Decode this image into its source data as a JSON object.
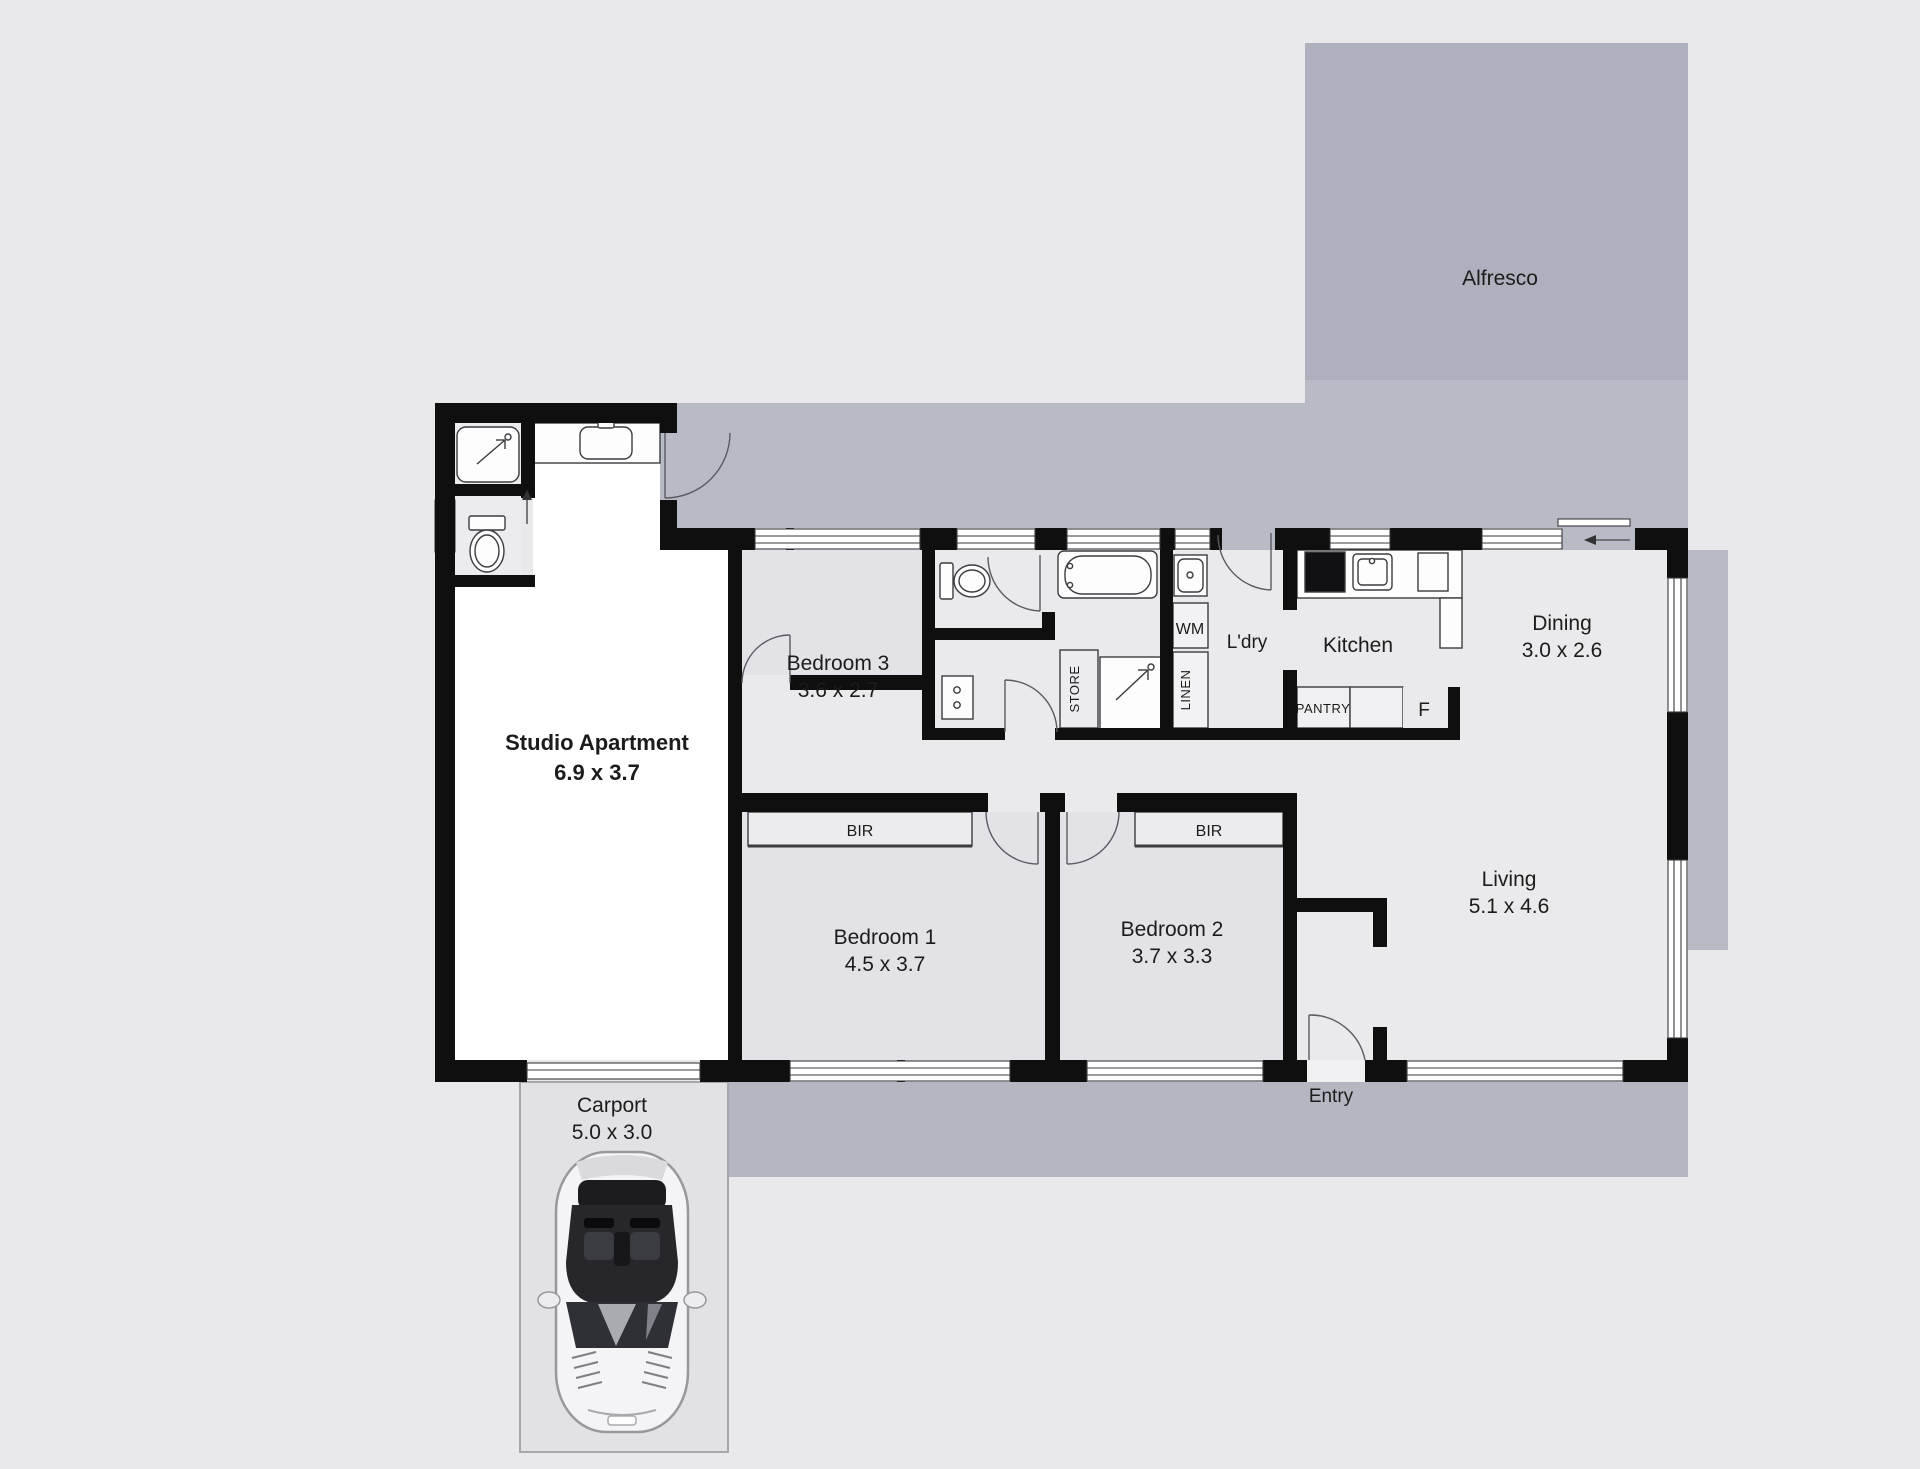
{
  "plan": {
    "alfresco": {
      "name": "Alfresco"
    },
    "studio": {
      "name": "Studio Apartment",
      "dims": "6.9 x 3.7"
    },
    "bedroom3": {
      "name": "Bedroom 3",
      "dims": "3.6 x 2.7"
    },
    "bedroom1": {
      "name": "Bedroom 1",
      "dims": "4.5 x 3.7"
    },
    "bedroom2": {
      "name": "Bedroom 2",
      "dims": "3.7 x 3.3"
    },
    "living": {
      "name": "Living",
      "dims": "5.1 x 4.6"
    },
    "dining": {
      "name": "Dining",
      "dims": "3.0 x 2.6"
    },
    "kitchen": {
      "name": "Kitchen"
    },
    "laundry": {
      "name": "L'dry"
    },
    "entry": {
      "name": "Entry"
    },
    "carport": {
      "name": "Carport",
      "dims": "5.0 x 3.0"
    },
    "cupboards": {
      "wm": "WM",
      "linen": "LINEN",
      "store": "STORE",
      "pantry": "PANTRY",
      "fridge": "F"
    },
    "bir": {
      "bedroom1": "BIR",
      "bedroom2": "BIR"
    },
    "colors": {
      "background": "#e9e9eb",
      "wall": "#0f0f10",
      "alfresco_fill": "#aeb0bd",
      "veranda_fill": "#b8bac5",
      "room_fill": "#e4e4e8",
      "studio_fill": "#ffffff",
      "carport_fill": "#e2e2e5"
    }
  }
}
